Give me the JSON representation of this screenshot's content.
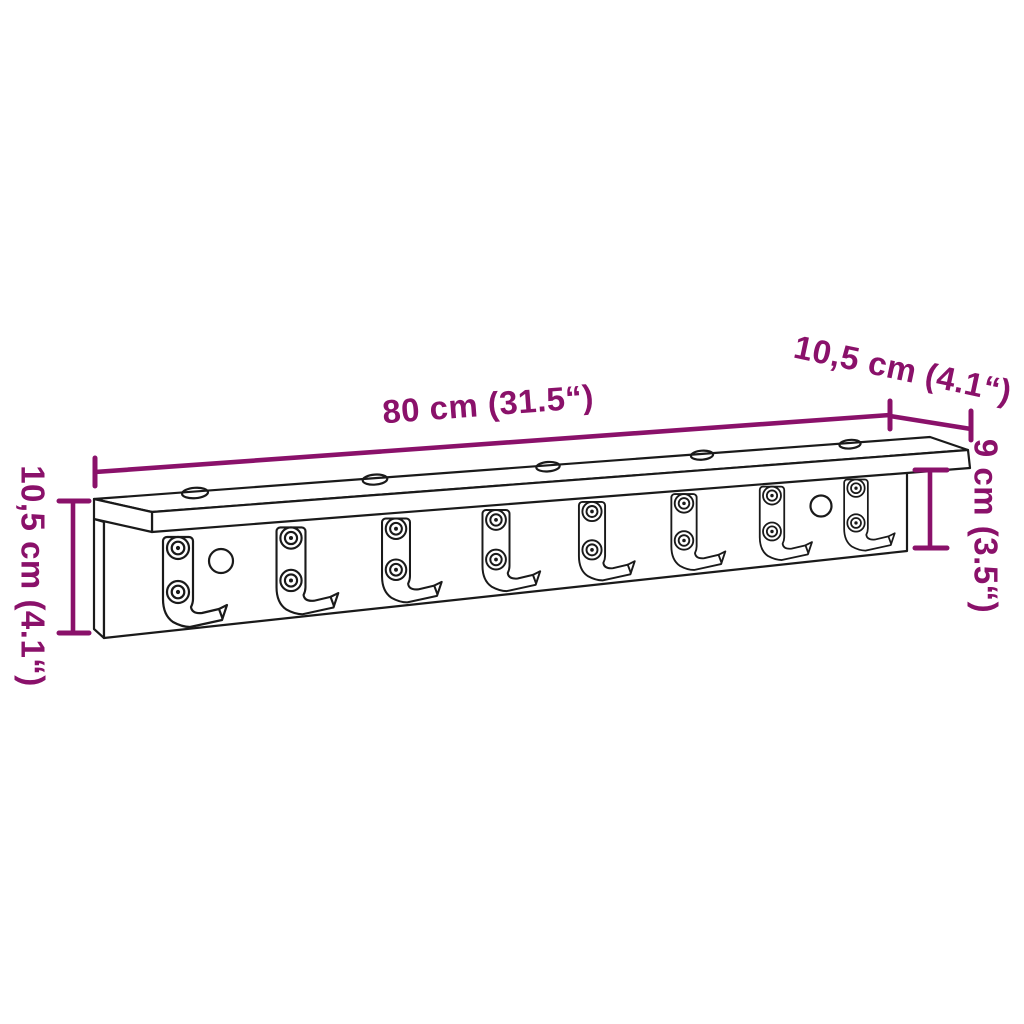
{
  "figure": {
    "type": "product dimension diagram",
    "product": "Wall-mounted coat rack with shelf and hooks",
    "hook_count": 8,
    "screws_per_hook": 2,
    "shelf_hole_count": 5,
    "panel_hole_count": 2
  },
  "dimensions": {
    "width": {
      "label": "80 cm (31.5“)"
    },
    "depth": {
      "label": "10,5 cm (4.1“)"
    },
    "height_left": {
      "label": "10,5 cm (4.1“)"
    },
    "height_right": {
      "label": "9 cm (3.5“)"
    }
  },
  "colors": {
    "dimension": "#8a116a",
    "ink": "#1a1a1a",
    "background": "#ffffff"
  }
}
